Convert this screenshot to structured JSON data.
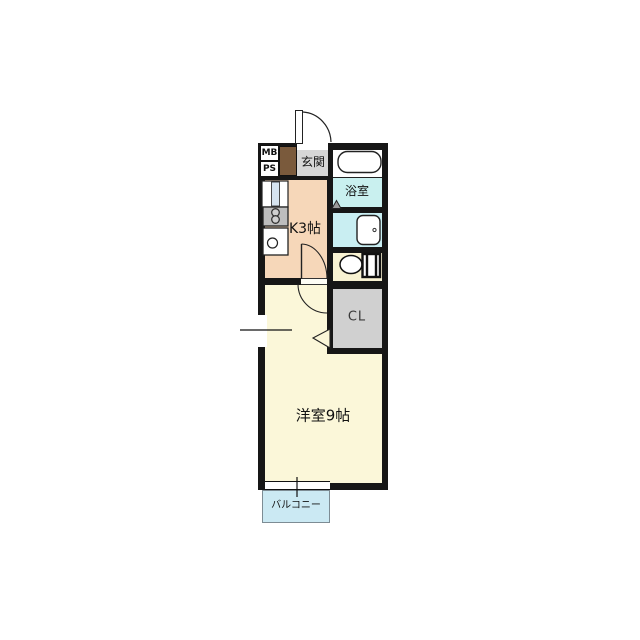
{
  "rooms": {
    "meter_box": "MB",
    "pipe_space": "PS",
    "entrance": "玄関",
    "kitchen": "K3帖",
    "bathroom": "浴室",
    "closet": "CL",
    "western_room": "洋室9帖",
    "balcony": "バルコニー"
  },
  "colors": {
    "wall": "#161616",
    "kitchen": "#F6D7B9",
    "entrance_floor": "#D6D6D6",
    "bathroom": "#C9F0EF",
    "washroom": "#C9EEF2",
    "toilet_room": "#F8F2D2",
    "closet": "#D0D0D0",
    "western_room": "#FBF7D9",
    "balcony": "#CBE9F3",
    "shoe_cabinet": "#7A5A3C"
  }
}
